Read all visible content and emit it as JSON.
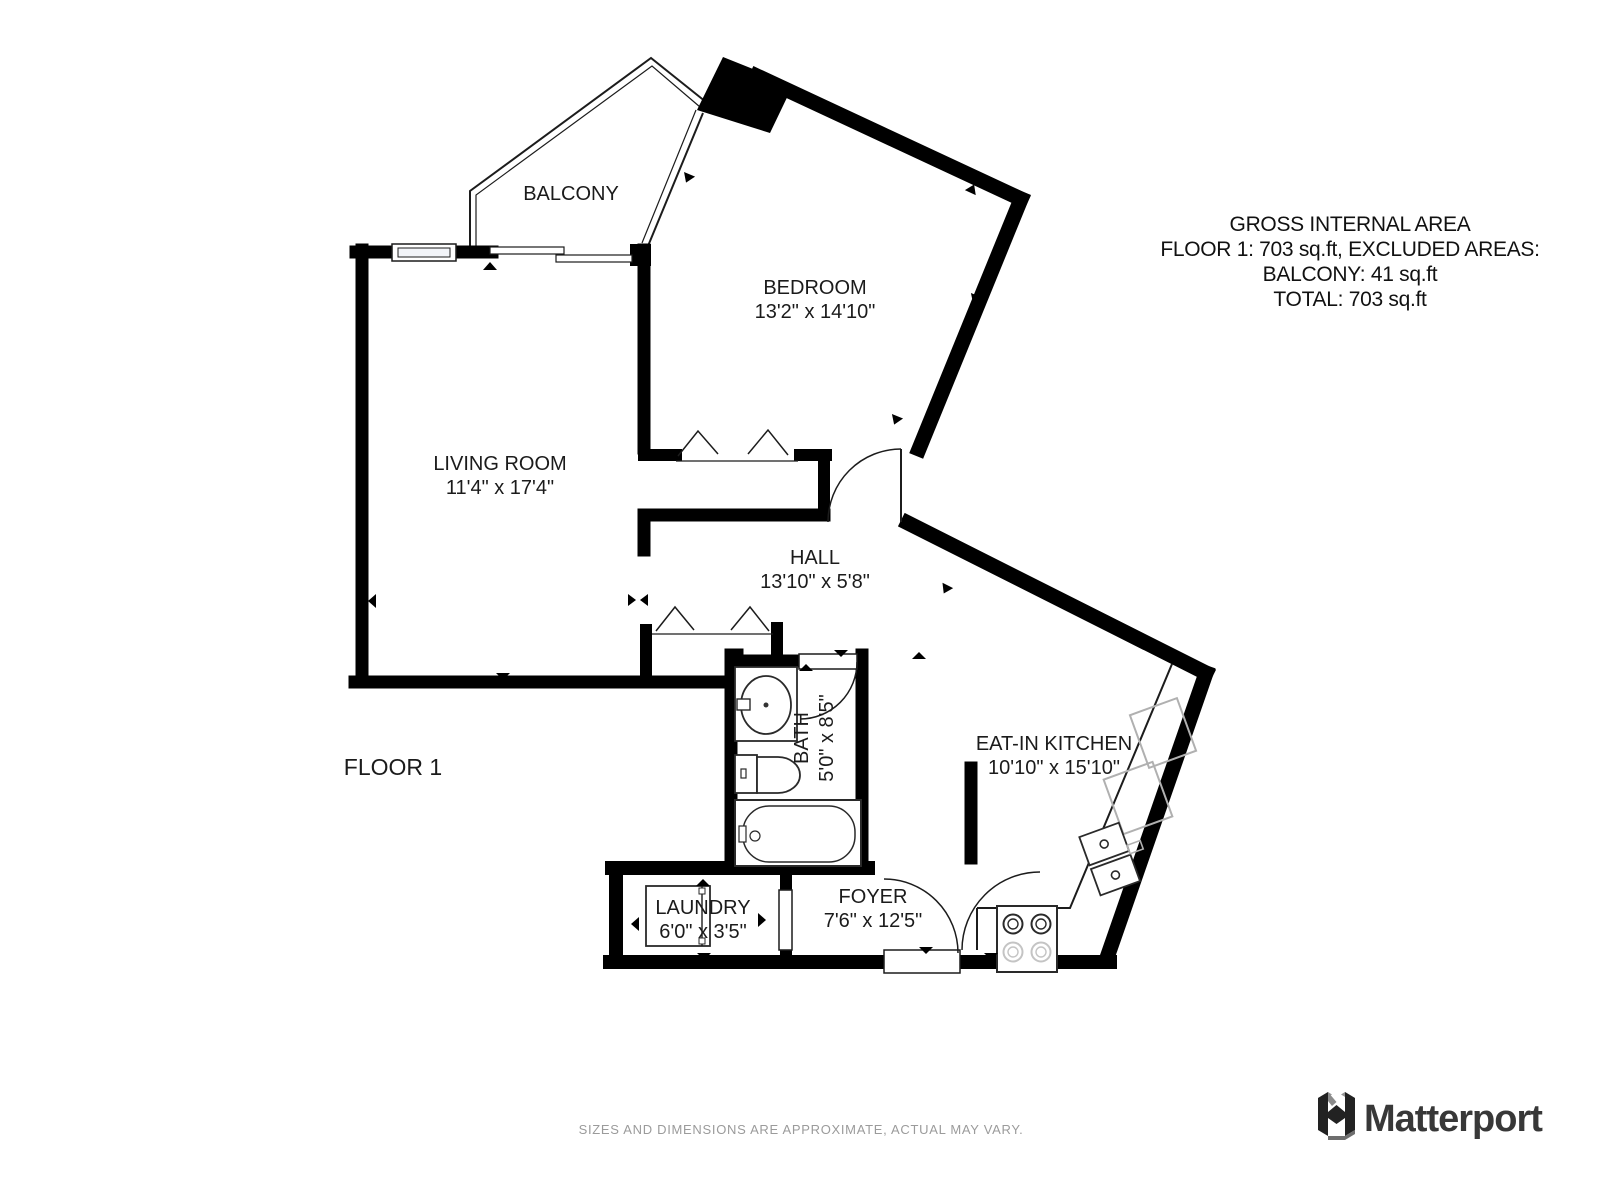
{
  "title_block": {
    "lines": [
      "GROSS INTERNAL AREA",
      "FLOOR 1: 703 sq.ft, EXCLUDED AREAS:",
      "BALCONY: 41 sq.ft",
      "TOTAL: 703 sq.ft"
    ]
  },
  "floor_label": "FLOOR 1",
  "rooms": {
    "balcony": {
      "name": "BALCONY"
    },
    "bedroom": {
      "name": "BEDROOM",
      "dims": "13'2\" x 14'10\""
    },
    "living_room": {
      "name": "LIVING ROOM",
      "dims": "11'4\" x 17'4\""
    },
    "hall": {
      "name": "HALL",
      "dims": "13'10\" x 5'8\""
    },
    "bath": {
      "name": "BATH",
      "dims": "5'0\" x 8'5\""
    },
    "eat_in_kitchen": {
      "name": "EAT-IN KITCHEN",
      "dims": "10'10\" x 15'10\""
    },
    "laundry": {
      "name": "LAUNDRY",
      "dims": "6'0\" x 3'5\""
    },
    "foyer": {
      "name": "FOYER",
      "dims": "7'6\" x 12'5\""
    }
  },
  "footer": {
    "disclaimer": "SIZES AND DIMENSIONS ARE APPROXIMATE, ACTUAL MAY VARY.",
    "brand": "Matterport"
  },
  "colors": {
    "wall": "#000000",
    "disclaimer_text": "#9b9b9b",
    "brand_text": "#383838",
    "appliance_gray": "#b0b0b0"
  }
}
